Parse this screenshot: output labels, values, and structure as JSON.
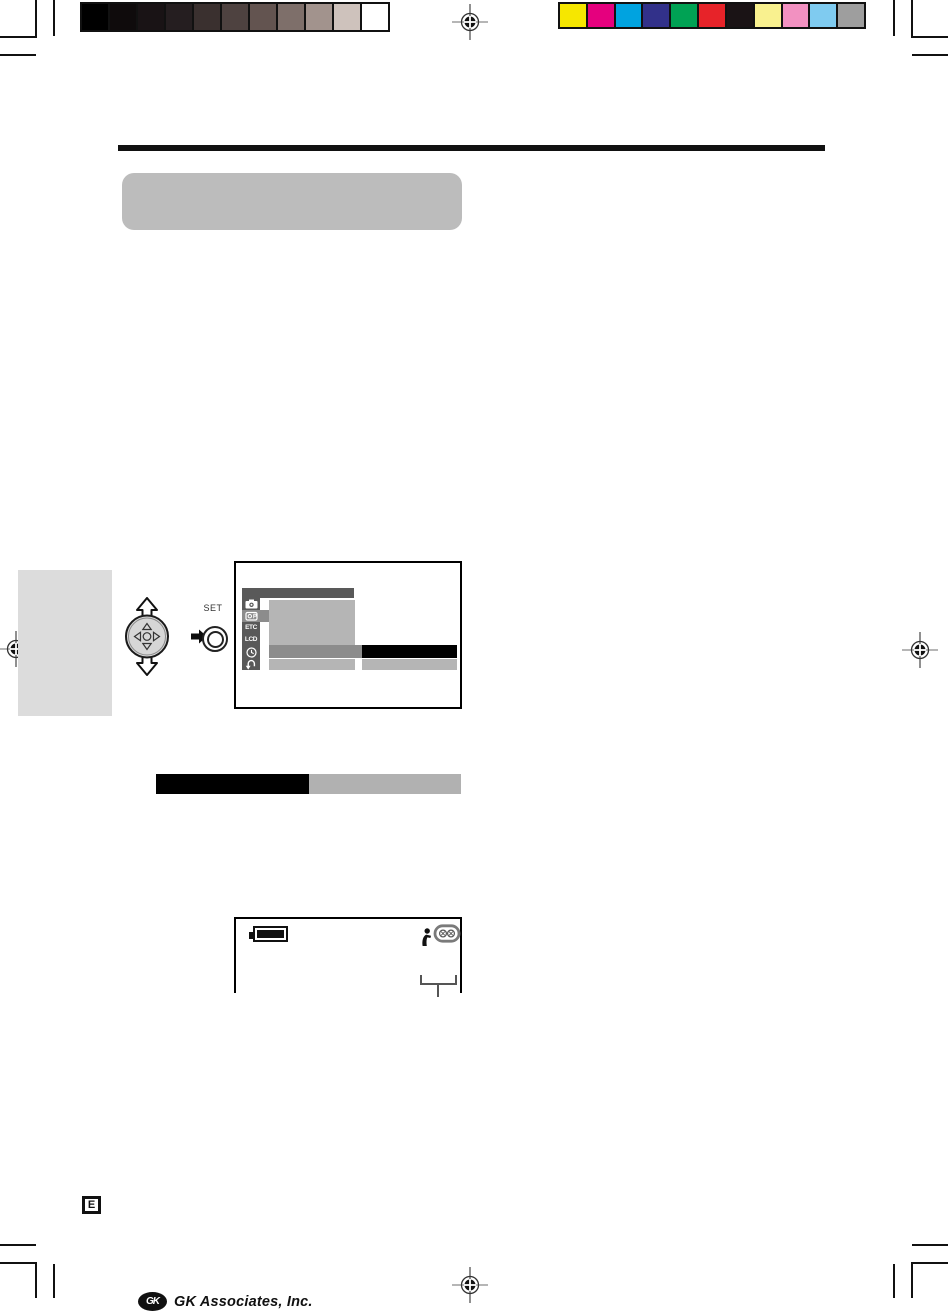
{
  "page_meta": {
    "edition_badge": "E"
  },
  "footer": {
    "logo_monogram": "GK",
    "company_name": "GK Associates, Inc."
  },
  "controls_illustration": {
    "set_button_label": "SET"
  },
  "menu_screen": {
    "tab_labels": {
      "etc": "ETC",
      "lcd": "LCD"
    },
    "sidebar_icon_names": [
      "camera-icon",
      "camera-playback-icon",
      "etc-tab",
      "lcd-tab",
      "clock-icon",
      "return-arrow-icon"
    ]
  },
  "status_screen": {
    "icon_names": [
      "battery-full-icon",
      "person-icon",
      "cassette-icon"
    ]
  },
  "print_calibration": {
    "grayscale_swatches": [
      "#000000",
      "#0f0b0c",
      "#191315",
      "#251e20",
      "#3a302f",
      "#4e4240",
      "#635450",
      "#7e6f6a",
      "#a2938d",
      "#cec2bc",
      "#ffffff"
    ],
    "color_swatches": [
      "#f6e700",
      "#e5007e",
      "#00a3e0",
      "#32318a",
      "#00a254",
      "#e72329",
      "#1a1315",
      "#f9f18f",
      "#f291c1",
      "#7fcbf0",
      "#9e9e9e"
    ]
  },
  "accent_colors": {
    "screen_dark_gray": "#595959",
    "screen_mid_gray": "#8c8c8c",
    "screen_light_gray": "#b5b5b5",
    "selection_black": "#000000",
    "bar_gray": "#b1b1b1",
    "section_header_gray": "#bcbcbc",
    "side_tab_gray": "#dcdcdc"
  }
}
